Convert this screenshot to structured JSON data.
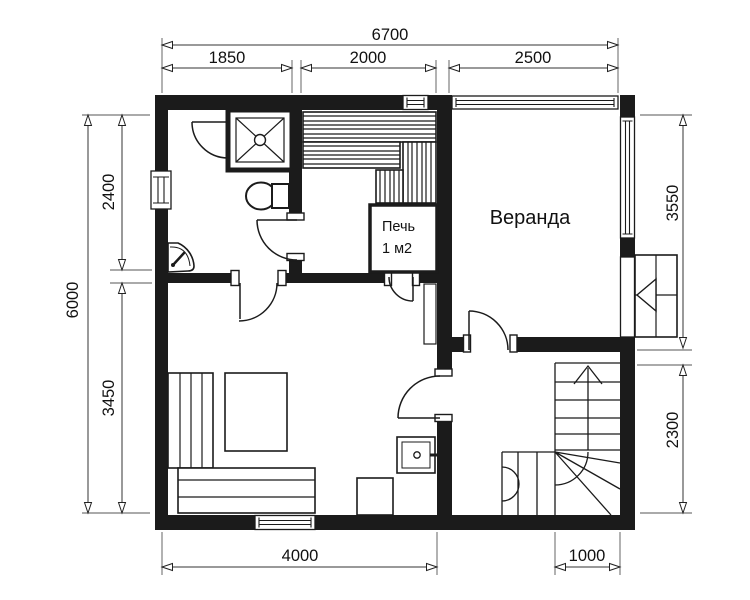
{
  "drawing": {
    "type": "floor-plan",
    "ink_color": "#1b1b1b",
    "background_color": "#ffffff"
  },
  "dims": {
    "top": {
      "total": "6700",
      "seg": [
        "1850",
        "2000",
        "2500"
      ]
    },
    "left": {
      "total": "6000",
      "seg": [
        "2400",
        "3450"
      ]
    },
    "right": {
      "seg": [
        "3550",
        "2300"
      ]
    },
    "bottom": {
      "seg": [
        "4000",
        "1000"
      ]
    }
  },
  "rooms": {
    "veranda": "Веранда",
    "stove": [
      "Печь",
      "1 м2"
    ]
  }
}
